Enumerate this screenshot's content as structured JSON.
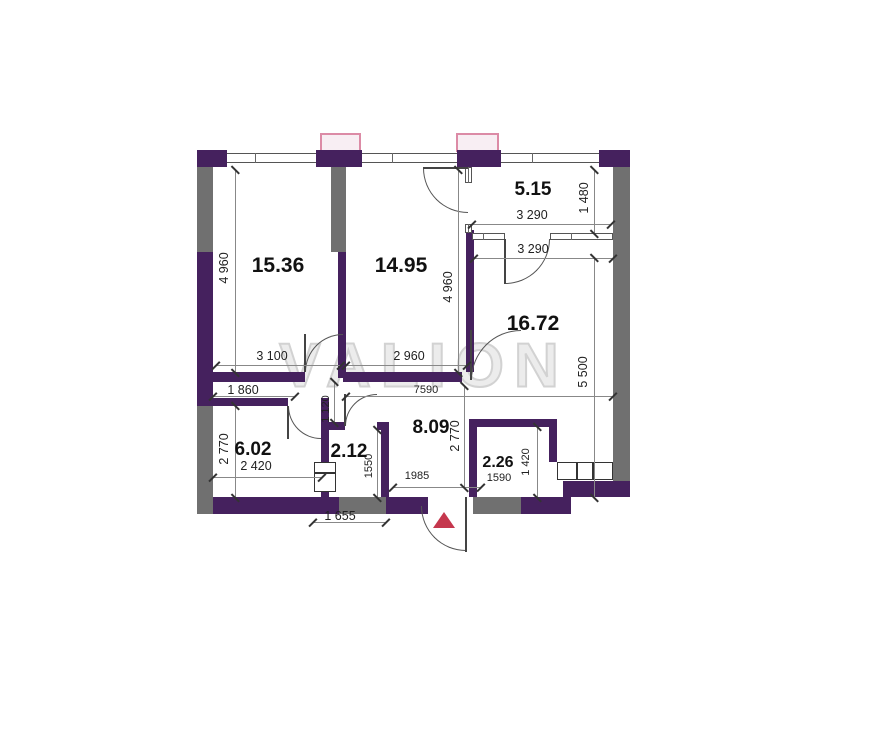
{
  "watermark": "VALION",
  "colors": {
    "wall_purple": "#45215e",
    "wall_concrete": "#707070",
    "vent_border": "#dc8ba6",
    "vent_fill": "#f8eef3",
    "entrance_marker": "#c5374d"
  },
  "rooms": {
    "r15_36": "15.36",
    "r14_95": "14.95",
    "r5_15": "5.15",
    "r16_72": "16.72",
    "r6_02": "6.02",
    "r2_12": "2.12",
    "r8_09": "8.09",
    "r2_26": "2.26"
  },
  "dims": {
    "d4960_left": "4 960",
    "d4960_right": "4 960",
    "d3100": "3 100",
    "d2960": "2 960",
    "d3290_top": "3 290",
    "d3290_bottom": "3 290",
    "d1480": "1 480",
    "d5500": "5 500",
    "d1860": "1 860",
    "d1120": "1 120",
    "d7590": "7590",
    "d2770_left": "2 770",
    "d2770_right": "2 770",
    "d2420": "2 420",
    "d1550": "1550",
    "d1985": "1985",
    "d1655": "1 655",
    "d1590": "1590",
    "d1420": "1 420"
  }
}
